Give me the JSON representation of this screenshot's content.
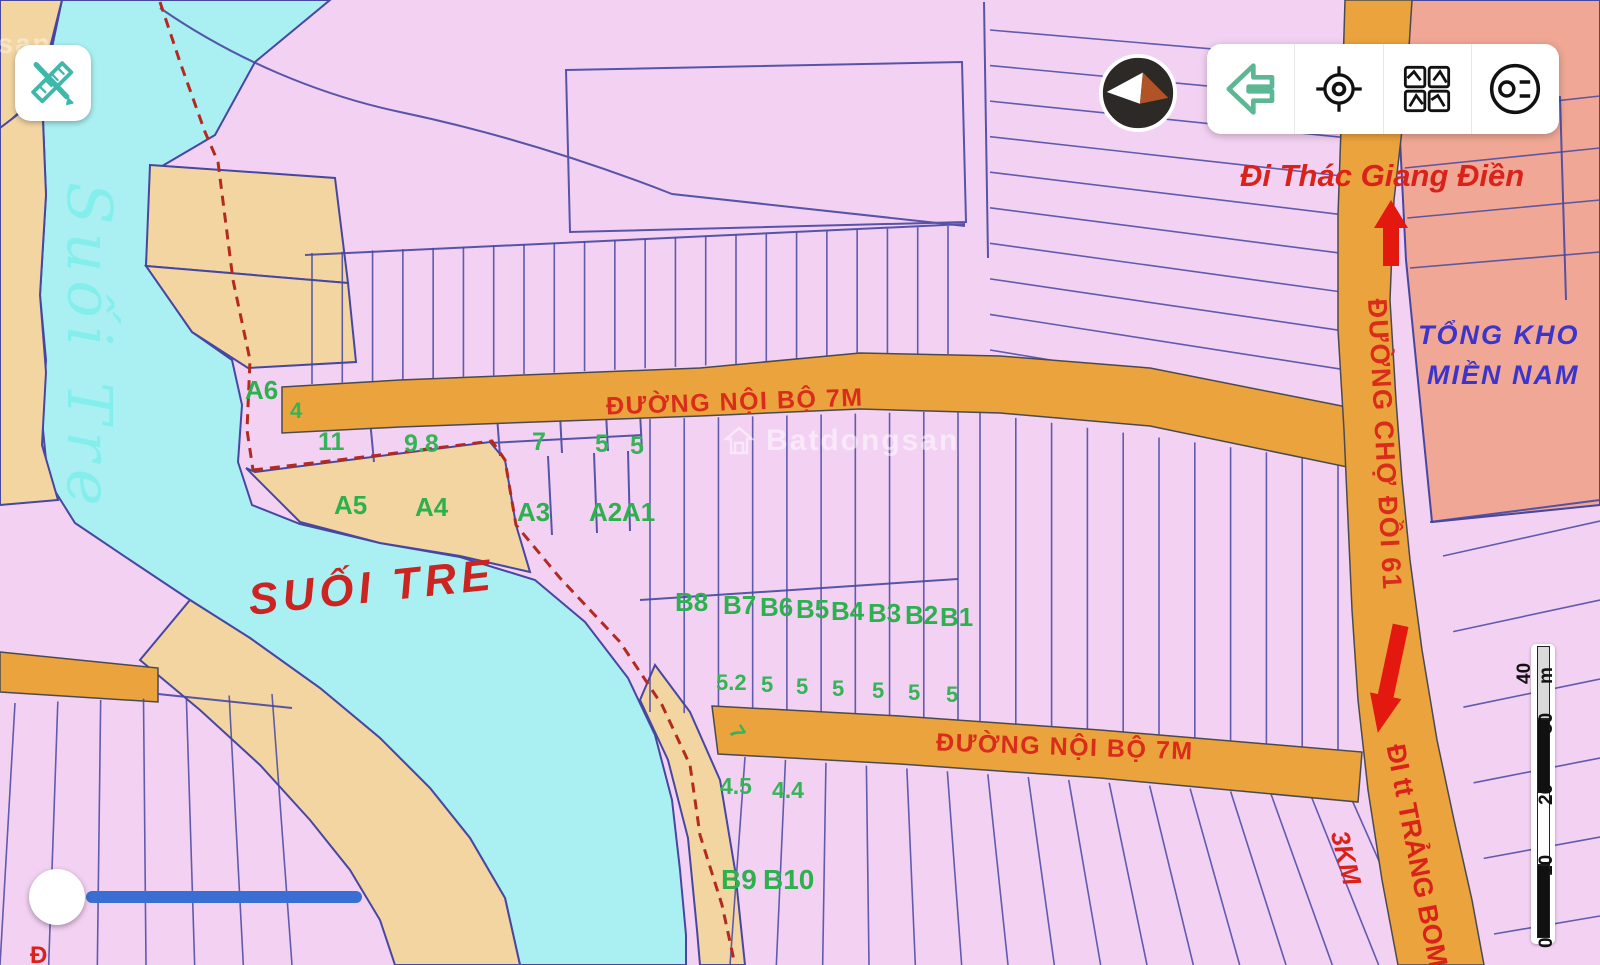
{
  "map": {
    "river": {
      "name_vertical": "Suối Tre",
      "name_horizontal": "SUỐI TRE"
    },
    "roads": {
      "internal_top": "ĐƯỜNG NỘI BỘ 7M",
      "internal_bottom": "ĐƯỜNG NỘI BỘ 7M",
      "market": "ĐƯỜNG CHỢ ĐỒI 61"
    },
    "directions": {
      "north": "Đi Thác Giang Điền",
      "south": "ĐI tt TRẢNG BOM",
      "south_distance": "3KM"
    },
    "area": {
      "line1": "TỔNG KHO",
      "line2": "MIỀN NAM"
    },
    "plots": {
      "a": [
        "A6",
        "A5",
        "A4",
        "A3",
        "A2",
        "A1"
      ],
      "b_top": [
        "B8",
        "B7",
        "B6",
        "B5",
        "B4",
        "B3",
        "B2",
        "B1"
      ],
      "b_bottom": [
        "B9",
        "B10"
      ]
    },
    "dimensions": {
      "a_row": [
        "4",
        "11",
        "9.8",
        "7",
        "5",
        "5"
      ],
      "b_row": [
        "5.2",
        "5",
        "5",
        "5",
        "5",
        "5",
        "5"
      ],
      "c_row": [
        "7",
        "4.5",
        "4.4"
      ],
      "partial_bottom": "Đ"
    }
  },
  "watermark": {
    "brand": "Batdongsan"
  },
  "scalebar": {
    "labels": [
      "0",
      "10",
      "20",
      "30",
      "40 m"
    ]
  },
  "colors": {
    "parcel_pink": "#f3d1f2",
    "road_orange": "#eaa33d",
    "river_cyan": "#aaf0f2",
    "bank_tan": "#f3d5a2",
    "warehouse_salmon": "#f0a795",
    "line_navy": "#4747a1",
    "label_green": "#2db14e",
    "label_red": "#d92c1a",
    "label_blue": "#3b35cc",
    "measure_blue": "#3a6ed2"
  }
}
